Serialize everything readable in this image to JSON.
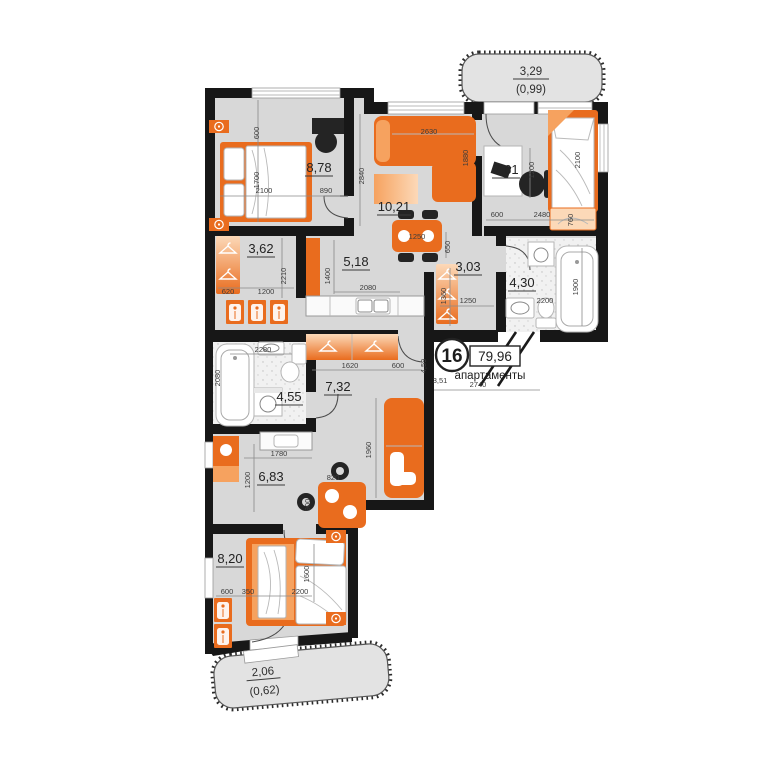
{
  "unit": {
    "number": "16",
    "area": "79,96",
    "type_label": "апартаменты"
  },
  "balconies": {
    "top": {
      "area": "3,29",
      "coeff": "(0,99)"
    },
    "bottom": {
      "area": "2,06",
      "coeff": "(0,62)"
    }
  },
  "rooms": {
    "bedroom1": "8,78",
    "living": "10,21",
    "bedroom2": "7,61",
    "dressing": "3,62",
    "kitchen": "5,18",
    "hall": "3,03",
    "bathroom1": "4,30",
    "corridor": "7,32",
    "bathroom2": "4,55",
    "kitchen_living": "6,83",
    "bedroom3": "8,20"
  },
  "dims": {
    "b1_600": "600",
    "b1_1700": "1700",
    "b1_2100": "2100",
    "b1_890": "890",
    "lv_2840": "2840",
    "lv_2630": "2630",
    "lv_1880": "1880",
    "b2_1200": "1200",
    "b2_600": "600",
    "b2_2480": "2480",
    "b2_2100": "2100",
    "b2_760": "760",
    "dr_620": "620",
    "dr_1200": "1200",
    "dr_2210": "2210",
    "k_1400": "1400",
    "k_2080": "2080",
    "k_1250": "1250",
    "k_650": "650",
    "h_1360": "1360",
    "h_1250": "1250",
    "ba1_1900": "1900",
    "ba1_2200": "2200",
    "ba2_2280": "2280",
    "ba2_2080": "2080",
    "c_1620": "1620",
    "c_600": "600",
    "c_459": "4,59",
    "c_351": "3,51",
    "c_2740": "2740",
    "c_1960": "1960",
    "k2_1780": "1780",
    "k2_1200": "1200",
    "k2_820": "820",
    "k2_900": "900",
    "b3_600": "600",
    "b3_350": "350",
    "b3_2200": "2200",
    "b3_1600": "1600"
  },
  "colors": {
    "accent": "#e96c1e",
    "accent-light": "#f6a25f",
    "accent-pale": "#fcd9b8",
    "floor": "#d8d8d8",
    "floor-light": "#f1f1f1",
    "wall": "#171717",
    "dim": "#3c3c3c",
    "balcony": "#e3e3e3"
  }
}
